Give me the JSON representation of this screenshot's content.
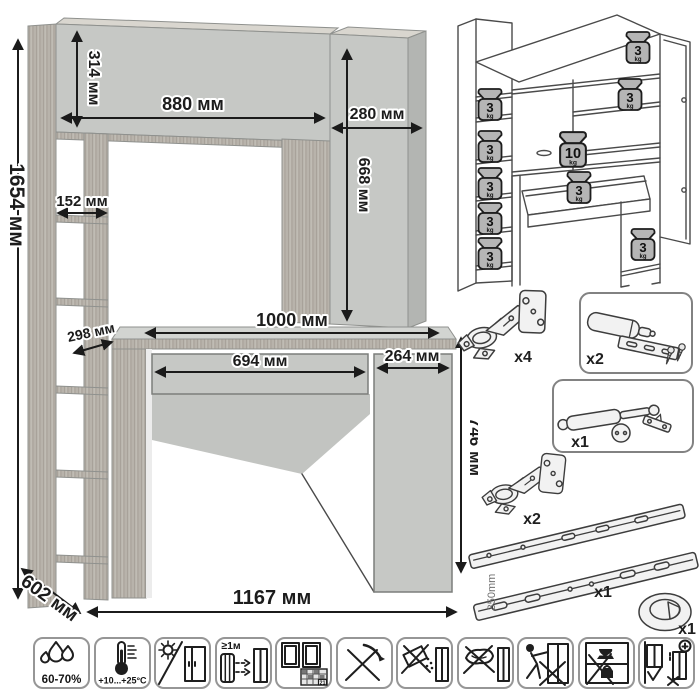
{
  "dimension_drawing": {
    "dims": {
      "total_height": "1654 мм",
      "hutch_height": "314 мм",
      "hutch_opening_width": "880 мм",
      "side_column_width": "280 мм",
      "side_column_height": "668 мм",
      "shelf_width": "152 мм",
      "shelf_depth": "298 мм",
      "desktop_width": "1000 мм",
      "drawer_width": "694 мм",
      "pedestal_width": "264 мм",
      "desk_height": "746 мм",
      "total_width": "1167 мм",
      "total_depth": "602 мм"
    }
  },
  "load_capacity": {
    "weights": [
      {
        "value": "3",
        "unit": "kg"
      },
      {
        "value": "3",
        "unit": "kg"
      },
      {
        "value": "3",
        "unit": "kg"
      },
      {
        "value": "3",
        "unit": "kg"
      },
      {
        "value": "3",
        "unit": "kg"
      },
      {
        "value": "3",
        "unit": "kg"
      },
      {
        "value": "3",
        "unit": "kg"
      },
      {
        "value": "10",
        "unit": "kg"
      },
      {
        "value": "3",
        "unit": "kg"
      },
      {
        "value": "3",
        "unit": "kg"
      }
    ]
  },
  "hardware": {
    "items": [
      {
        "name": "concealed hinge",
        "qty": "x4"
      },
      {
        "name": "door damper",
        "qty": "x2"
      },
      {
        "name": "gas lift",
        "qty": "x1"
      },
      {
        "name": "concealed hinge",
        "qty": "x2"
      },
      {
        "name": "drawer slides",
        "qty": "x1",
        "length": "350mm"
      },
      {
        "name": "cable grommet",
        "qty": "x1"
      }
    ]
  },
  "care_icons": {
    "items": [
      {
        "name": "humidity-range",
        "label": "60-70%"
      },
      {
        "name": "temperature-range",
        "label": "+10...+25°C"
      },
      {
        "name": "avoid-direct-sunlight"
      },
      {
        "name": "heater-distance",
        "label": "≥1м"
      },
      {
        "name": "ventilate-room",
        "label": "21"
      },
      {
        "name": "no-sharp-tools"
      },
      {
        "name": "no-abrasive-cleaners"
      },
      {
        "name": "no-wet-cloth"
      },
      {
        "name": "no-dragging"
      },
      {
        "name": "no-heavy-items-on-top"
      },
      {
        "name": "anchor-to-wall"
      }
    ]
  },
  "colors": {
    "panel": "#c6c8c5",
    "panel_side": "#b3b5b2",
    "wood": "#b8b3ab",
    "line": "#1c1c1c"
  }
}
